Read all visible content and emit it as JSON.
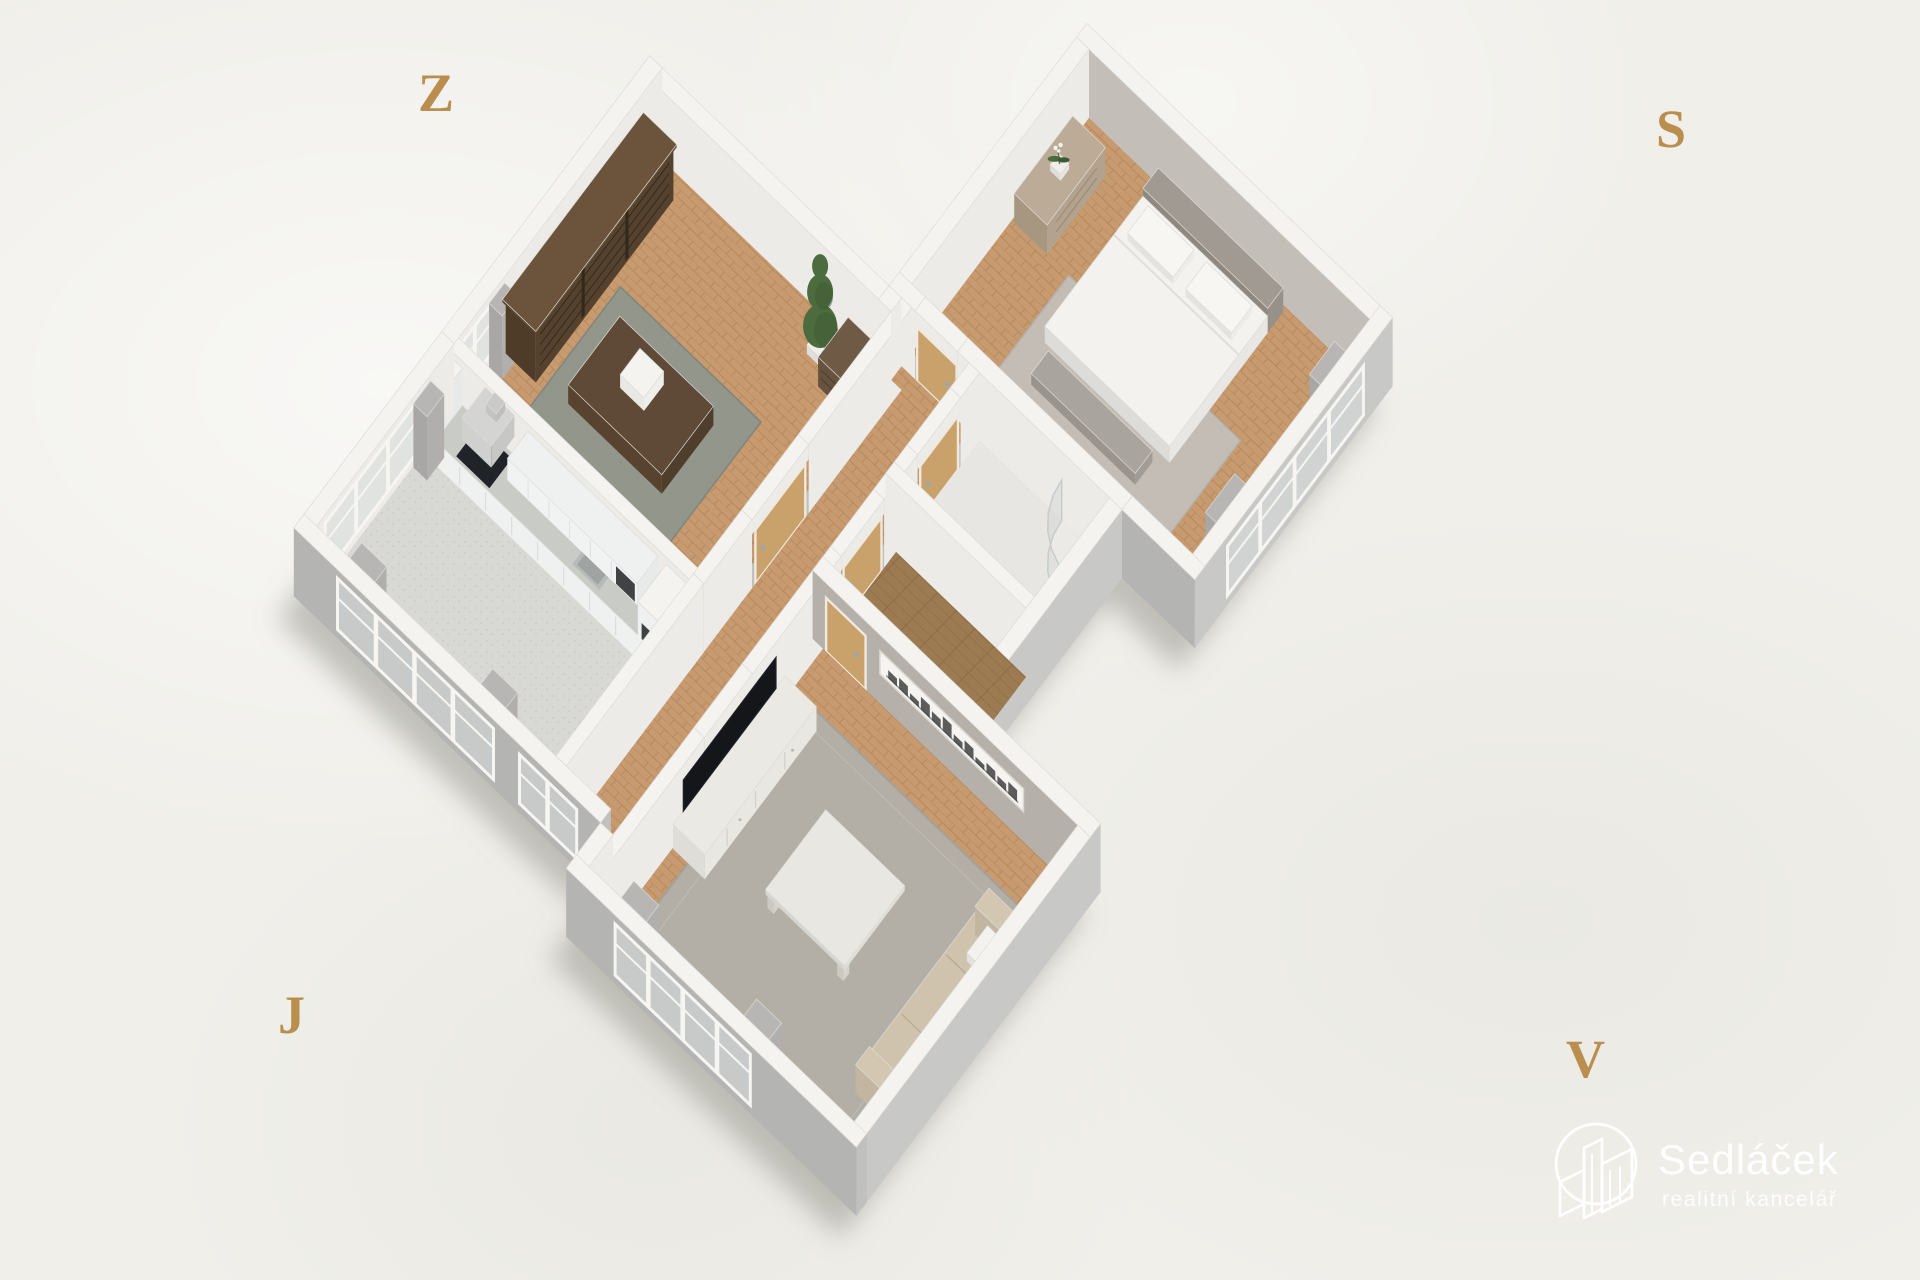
{
  "canvas": {
    "width": 1920,
    "height": 1280,
    "background_color": "#f0efea"
  },
  "compass": {
    "color": "#b98e4f",
    "west": "Z",
    "north": "S",
    "south": "J",
    "east": "V"
  },
  "watermark": {
    "title": "Sedláček",
    "subtitle": "realitní kancelář",
    "color": "#ffffff",
    "icon": "buildings-in-circle-icon"
  },
  "scene": {
    "type": "apartment-floorplan-3d",
    "view": "isometric dollhouse render, no visible text labels",
    "rooms": [
      {
        "id": "study",
        "label": "study / library with bookshelf and desk"
      },
      {
        "id": "kitchen",
        "label": "kitchen with white L-counter"
      },
      {
        "id": "hallway",
        "label": "central hallway with oak doors"
      },
      {
        "id": "bathroom",
        "label": "bathroom with corner shower"
      },
      {
        "id": "closet",
        "label": "storage closet"
      },
      {
        "id": "bedroom",
        "label": "bedroom with double bed"
      },
      {
        "id": "living",
        "label": "living room with TV and sofa"
      }
    ],
    "palette": {
      "wall_top": "#f4f3f0",
      "wall_inner": "#ecebe7",
      "wall_inner_warm": "#edebe7",
      "wall_accent_bedroom": "#c3beb8",
      "wall_accent_living": "#b5b0a9",
      "wall_outer_south": "#b4b4b2",
      "wall_outer_east": "#c8c8c6",
      "wall_outer_cap": "#c0c0be",
      "floor_wood": "#c79a6f",
      "floor_wood_stripe": "#b7895c",
      "floor_plank": "#9c7b53",
      "floor_plank_stripe": "#8d6c45",
      "floor_tile": "#d8d9d5",
      "floor_tile_dot": "#c9cac6",
      "floor_bath": "#e7e6e2",
      "door_oak": "#c9a26b",
      "door_frame": "#efe9df",
      "handle_chrome": "#9fa6ab",
      "glass": "#d7dcdc",
      "window_frame": "#f6f5f2",
      "curtain": "#b7b6b4",
      "bookshelf_dark": "#55422e",
      "furniture_dark_wood": "#5e4a37",
      "dresser_wood": "#66523e",
      "dresser_greige": "#b3a28d",
      "rug_study": "#8e968c",
      "rug_living": "#b2b0ab",
      "rug_bedroom": "#c3c1bc",
      "sofa_beige": "#c7bba6",
      "tv_black": "#14161a",
      "furniture_white": "#e9e7e1",
      "counter_top": "#c9cbc7",
      "cabinet_white": "#eff1f0",
      "hood_gray": "#d0d1cf",
      "bed_white": "#f3f2ef",
      "bed_bench": "#a19c95",
      "plant_green": "#4c6b3f",
      "plant_green_dark": "#3e5a33",
      "artwork_dark": "#3a3a3a",
      "shadow": "#8f8f88"
    }
  }
}
